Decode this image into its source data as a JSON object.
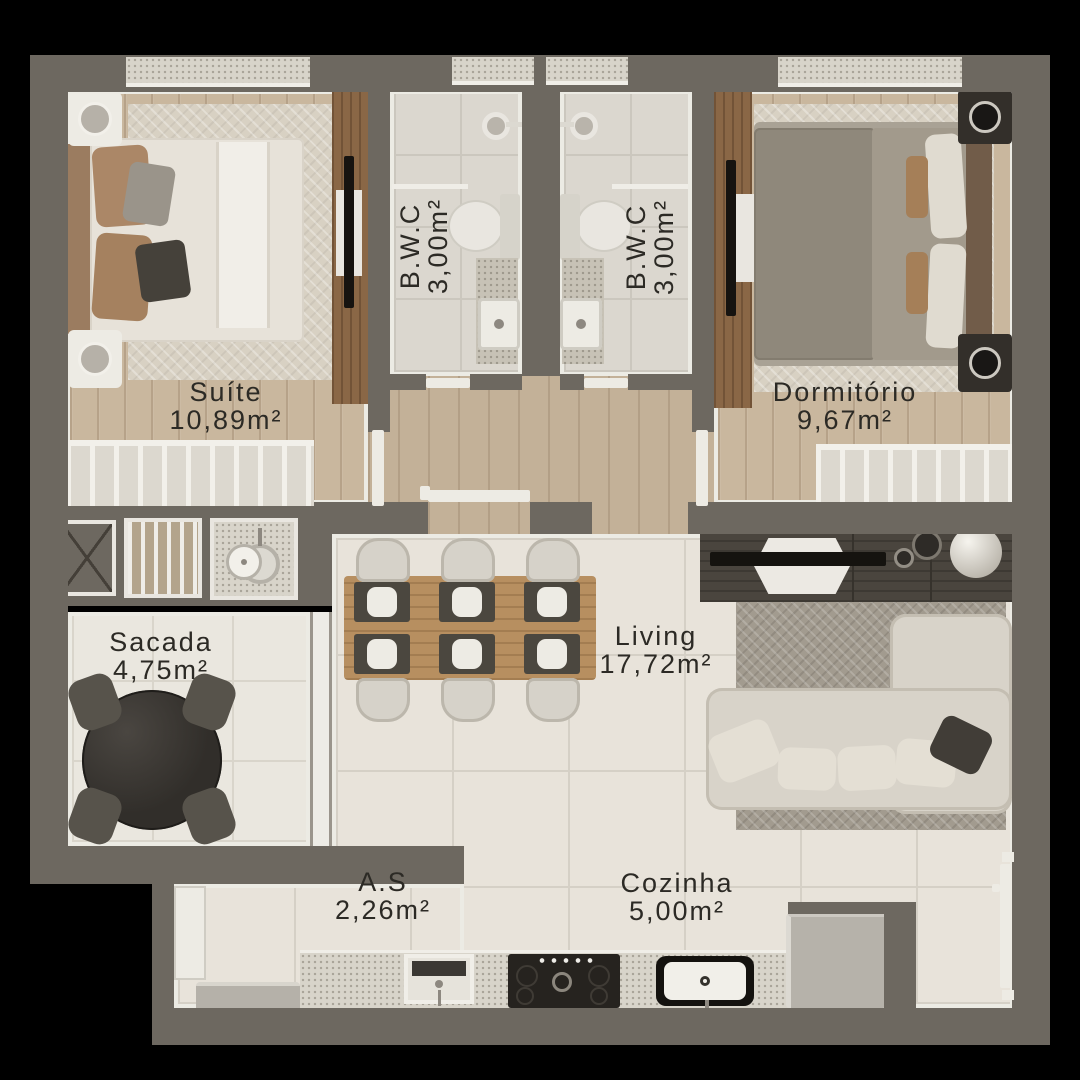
{
  "rooms": [
    {
      "name": "Suíte",
      "area": "10,89m²"
    },
    {
      "name": "B.W.C",
      "area": "3,00m²"
    },
    {
      "name": "B.W.C",
      "area": "3,00m²"
    },
    {
      "name": "Dormitório",
      "area": "9,67m²"
    },
    {
      "name": "Sacada",
      "area": "4,75m²"
    },
    {
      "name": "Living",
      "area": "17,72m²"
    },
    {
      "name": "A.S",
      "area": "2,26m²"
    },
    {
      "name": "Cozinha",
      "area": "5,00m²"
    }
  ],
  "colors": {
    "background": "#000000",
    "wall": "#6d6860",
    "wall_lining": "#ecebe4",
    "wood_floor": "#c9b79e",
    "tile_floor": "#e8e3da",
    "bath_tile": "#dbd7cf",
    "label_text": "#2c2a25",
    "accent_wood": "#8a6746",
    "sofa": "#d8d3c9"
  }
}
